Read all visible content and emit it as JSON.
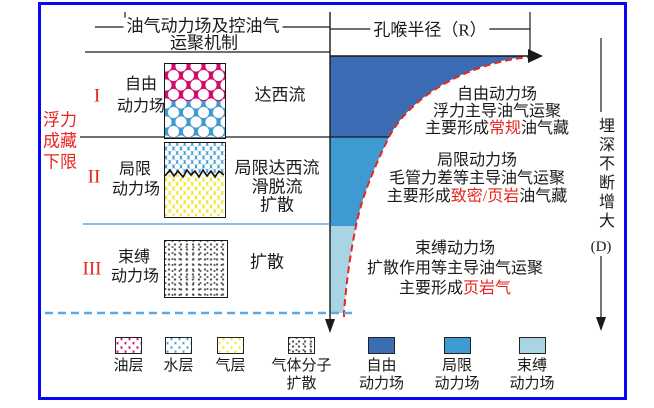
{
  "header": {
    "mechanism_title_line1": "油气动力场及控油气",
    "mechanism_title_line2": "运聚机制",
    "pore_radius_title": "孔喉半径（R）"
  },
  "buoyancy_limit": {
    "lines": [
      "浮力",
      "成藏",
      "下限"
    ]
  },
  "depth_axis": {
    "label": "埋深不断增大",
    "unit": "(D)"
  },
  "zones": [
    {
      "numeral": "I",
      "name_lines": [
        "自由",
        "动力场"
      ],
      "mechanisms": [
        "达西流"
      ],
      "description": {
        "line1": "自由动力场",
        "line2": "浮力主导油气运聚",
        "line3_pre": "主要形成",
        "line3_red": "常规",
        "line3_post": "油气藏"
      }
    },
    {
      "numeral": "II",
      "name_lines": [
        "局限",
        "动力场"
      ],
      "mechanisms": [
        "局限达西流",
        "滑脱流",
        "扩散"
      ],
      "description": {
        "line1": "局限动力场",
        "line2": "毛管力差等主导油气运聚",
        "line3_pre": "主要形成",
        "line3_red": "致密/页岩",
        "line3_post": "油气藏"
      }
    },
    {
      "numeral": "III",
      "name_lines": [
        "束缚",
        "动力场"
      ],
      "mechanisms": [
        "扩散"
      ],
      "description": {
        "line1": "束缚动力场",
        "line2": "扩散作用等主导油气运聚",
        "line3_pre": "主要形成",
        "line3_red": "页岩气",
        "line3_post": ""
      }
    }
  ],
  "legend": [
    {
      "swatch": "oil-layer-pattern",
      "lines": [
        "油层"
      ]
    },
    {
      "swatch": "water-layer-pattern",
      "lines": [
        "水层"
      ]
    },
    {
      "swatch": "gas-layer-pattern",
      "lines": [
        "气层"
      ]
    },
    {
      "swatch": "gas-molecule-diffusion",
      "lines": [
        "气体分子",
        "扩散"
      ]
    },
    {
      "swatch": "free-dynamic-field",
      "lines": [
        "自由",
        "动力场"
      ]
    },
    {
      "swatch": "limited-dynamic-field",
      "lines": [
        "局限",
        "动力场"
      ]
    },
    {
      "swatch": "bound-dynamic-field",
      "lines": [
        "束缚",
        "动力场"
      ]
    }
  ],
  "colors": {
    "frame": "#0808f2",
    "zone_free": "#3c6cb4",
    "zone_limited": "#3f9ad2",
    "zone_bound": "#a9d4e4",
    "oil": "#d20a6e",
    "water": "#3f9ad2",
    "gas": "#f0e41c",
    "accent_red": "#e8251f",
    "dashed_line": "#5da9e8"
  }
}
